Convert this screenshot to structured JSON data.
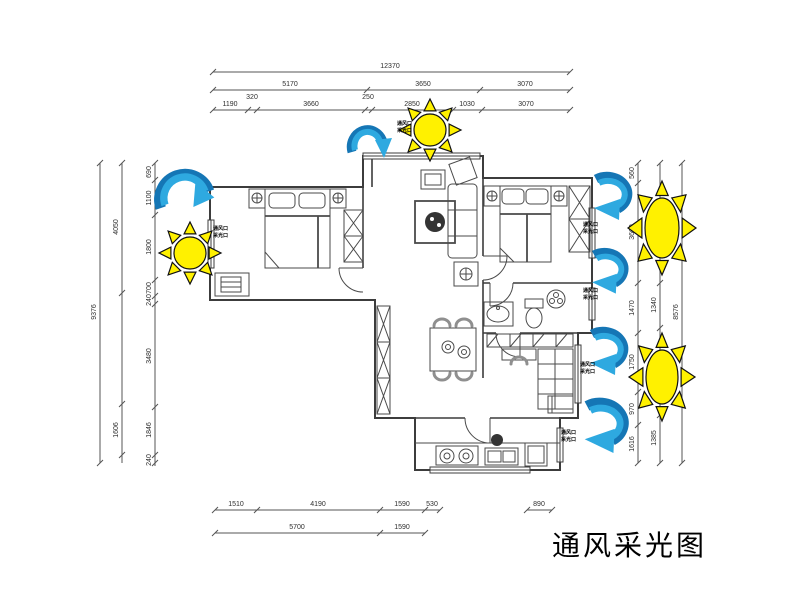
{
  "title": {
    "text": "通风采光图"
  },
  "colors": {
    "sun_fill": "#fff100",
    "arrow_dark": "#1576b5",
    "arrow_light": "#2ea9e0",
    "wall": "#3c3c3c",
    "furniture": "#4a4a4a",
    "dim": "#555555"
  },
  "flow_label_text": {
    "line1": "通风口",
    "line2": "采光口"
  },
  "flow_labels": [
    {
      "x": 397,
      "y": 121
    },
    {
      "x": 213,
      "y": 226
    },
    {
      "x": 583,
      "y": 222
    },
    {
      "x": 583,
      "y": 288
    },
    {
      "x": 580,
      "y": 362
    },
    {
      "x": 561,
      "y": 430
    }
  ],
  "suns": [
    {
      "name": "sun-top",
      "cx": 430,
      "cy": 130,
      "rx": 16,
      "ry": 16,
      "ray": 11
    },
    {
      "name": "sun-left",
      "cx": 190,
      "cy": 253,
      "rx": 16,
      "ry": 16,
      "ray": 11
    },
    {
      "name": "sun-right-upper",
      "cx": 662,
      "cy": 228,
      "rx": 17,
      "ry": 30,
      "ray": 13
    },
    {
      "name": "sun-right-lower",
      "cx": 662,
      "cy": 377,
      "rx": 16,
      "ry": 27,
      "ray": 13
    }
  ],
  "arrows": [
    {
      "name": "wind-arrow-entry",
      "type": "down",
      "cx": 367,
      "cy": 136,
      "s": 1.0
    },
    {
      "name": "wind-arrow-left",
      "type": "right",
      "cx": 186,
      "cy": 186,
      "s": 1.05
    },
    {
      "name": "wind-arrow-right-1",
      "type": "curl",
      "cx": 616,
      "cy": 193,
      "s": 1.0
    },
    {
      "name": "wind-arrow-right-2",
      "type": "curl",
      "cx": 613,
      "cy": 268,
      "s": 0.95
    },
    {
      "name": "wind-arrow-right-3",
      "type": "curl",
      "cx": 612,
      "cy": 348,
      "s": 1.0
    },
    {
      "name": "wind-arrow-right-4",
      "type": "curl",
      "cx": 610,
      "cy": 422,
      "s": 1.15
    }
  ],
  "dimensions": {
    "top": [
      {
        "y": 72,
        "segments": [
          [
            213,
            570
          ]
        ],
        "ticks": [
          213,
          570
        ],
        "labels": [
          {
            "v": "12370",
            "x": 390
          }
        ]
      },
      {
        "y": 90,
        "segments": [
          [
            213,
            570
          ]
        ],
        "ticks": [
          213,
          367,
          480,
          570
        ],
        "labels": [
          {
            "v": "5170",
            "x": 290
          },
          {
            "v": "3650",
            "x": 423
          },
          {
            "v": "3070",
            "x": 525
          }
        ]
      },
      {
        "y": 110,
        "segments": [
          [
            213,
            570
          ]
        ],
        "ticks": [
          213,
          248,
          257,
          365,
          372,
          453,
          482,
          570
        ],
        "labels": [
          {
            "v": "1190",
            "x": 230
          },
          {
            "v": "320",
            "x": 252,
            "dy": -7
          },
          {
            "v": "3660",
            "x": 311
          },
          {
            "v": "250",
            "x": 368,
            "dy": -7
          },
          {
            "v": "2850",
            "x": 412
          },
          {
            "v": "1030",
            "x": 467
          },
          {
            "v": "3070",
            "x": 526
          }
        ]
      }
    ],
    "bottom": [
      {
        "y": 510,
        "segments": [
          [
            215,
            440
          ],
          [
            527,
            552
          ]
        ],
        "ticks": [
          215,
          257,
          380,
          425,
          440,
          527,
          552
        ],
        "labels": [
          {
            "v": "1510",
            "x": 236
          },
          {
            "v": "4190",
            "x": 318
          },
          {
            "v": "1590",
            "x": 402
          },
          {
            "v": "530",
            "x": 432
          },
          {
            "v": "890",
            "x": 539
          }
        ]
      },
      {
        "y": 533,
        "segments": [
          [
            215,
            425
          ]
        ],
        "ticks": [
          215,
          380,
          425
        ],
        "labels": [
          {
            "v": "5700",
            "x": 297
          },
          {
            "v": "1590",
            "x": 402
          }
        ]
      }
    ],
    "left": [
      {
        "x": 100,
        "y1": 163,
        "y2": 463,
        "ticks": [
          163,
          463
        ],
        "labels": [
          {
            "v": "9376",
            "y": 312
          }
        ]
      },
      {
        "x": 122,
        "y1": 163,
        "y2": 463,
        "ticks": [
          163,
          293,
          404,
          455
        ],
        "labels": [
          {
            "v": "4050",
            "y": 227
          },
          {
            "v": "1606",
            "y": 430
          }
        ]
      },
      {
        "x": 155,
        "y1": 163,
        "y2": 466,
        "ticks": [
          163,
          180,
          215,
          280,
          296,
          304,
          407,
          455,
          463
        ],
        "labels": [
          {
            "v": "690",
            "y": 172
          },
          {
            "v": "1100",
            "y": 198
          },
          {
            "v": "1800",
            "y": 247
          },
          {
            "v": "700",
            "y": 288
          },
          {
            "v": "240",
            "y": 300
          },
          {
            "v": "3480",
            "y": 356
          },
          {
            "v": "1846",
            "y": 430
          },
          {
            "v": "240",
            "y": 460
          }
        ]
      }
    ],
    "right": [
      {
        "x": 638,
        "y1": 163,
        "y2": 463,
        "ticks": [
          163,
          183,
          283,
          333,
          392,
          425,
          463
        ],
        "labels": [
          {
            "v": "560",
            "y": 173
          },
          {
            "v": "3660",
            "y": 232
          },
          {
            "v": "1470",
            "y": 308
          },
          {
            "v": "1750",
            "y": 362
          },
          {
            "v": "970",
            "y": 409
          },
          {
            "v": "1616",
            "y": 444
          }
        ]
      },
      {
        "x": 660,
        "y1": 163,
        "y2": 463,
        "ticks": [
          163,
          283,
          328,
          415,
          463
        ],
        "labels": [
          {
            "v": "1340",
            "y": 305
          },
          {
            "v": "1385",
            "y": 438
          }
        ]
      },
      {
        "x": 682,
        "y1": 163,
        "y2": 463,
        "ticks": [
          163,
          463
        ],
        "labels": [
          {
            "v": "8576",
            "y": 312
          }
        ]
      }
    ]
  }
}
